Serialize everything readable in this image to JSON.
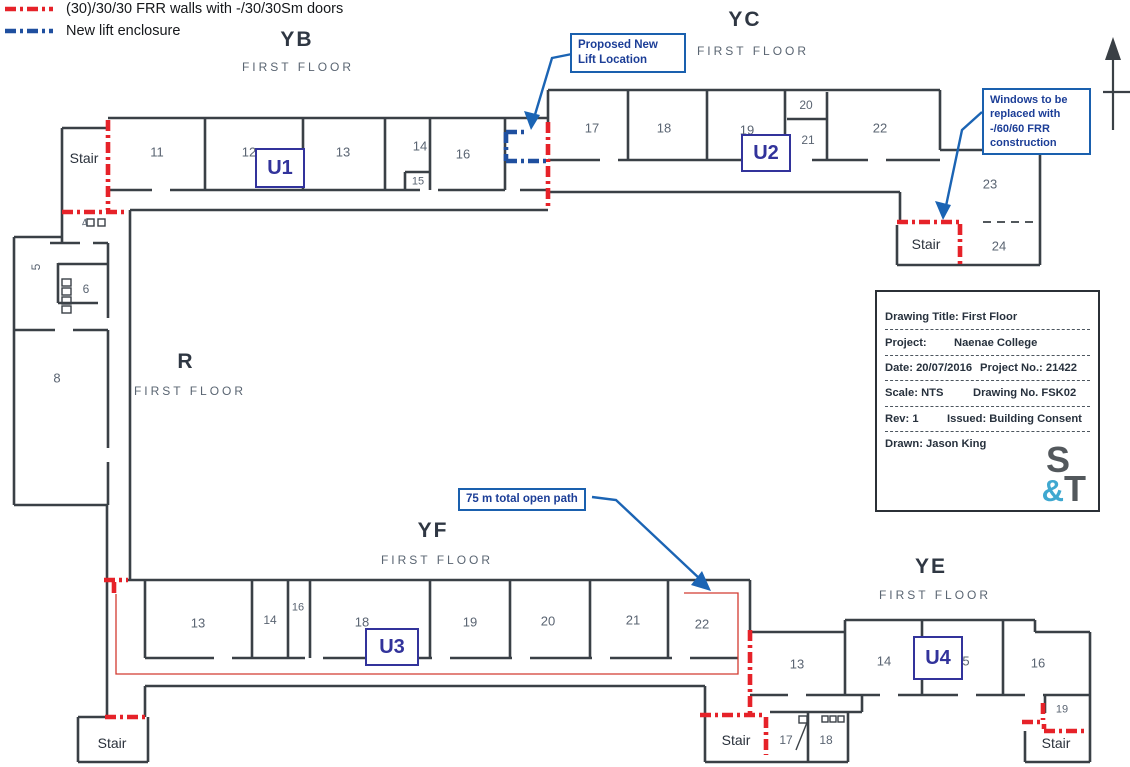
{
  "legend": {
    "items": [
      {
        "name": "frr-walls",
        "label": "(30)/30/30 FRR walls with -/30/30Sm doors",
        "color": "#e62229"
      },
      {
        "name": "new-lift-enclosure",
        "label": "New lift enclosure",
        "color": "#1f4f9f"
      }
    ]
  },
  "blocks": [
    {
      "code": "YB",
      "floor": "FIRST FLOOR"
    },
    {
      "code": "YC",
      "floor": "FIRST FLOOR"
    },
    {
      "code": "R",
      "floor": "FIRST FLOOR"
    },
    {
      "code": "YF",
      "floor": "FIRST FLOOR"
    },
    {
      "code": "YE",
      "floor": "FIRST FLOOR"
    }
  ],
  "callouts": {
    "lift": "Proposed New Lift Location",
    "windows": "Windows to be replaced with -/60/60 FRR construction",
    "open_path": "75 m total open path"
  },
  "title_block": {
    "drawing_title": "Drawing Title: First Floor",
    "project_label": "Project:",
    "project_value": "Naenae College",
    "date": "Date: 20/07/2016",
    "project_no": "Project No.: 21422",
    "scale": "Scale: NTS",
    "drawing_no": "Drawing No. FSK02",
    "rev": "Rev: 1",
    "issued": "Issued: Building Consent",
    "drawn": "Drawn: Jason King",
    "logo": {
      "s": "S",
      "amp": "&",
      "t": "T"
    }
  },
  "plan": {
    "rooms": [
      {
        "t": "11",
        "x": 157,
        "y": 152
      },
      {
        "t": "12",
        "x": 249,
        "y": 152
      },
      {
        "t": "13",
        "x": 343,
        "y": 152
      },
      {
        "t": "14",
        "x": 420,
        "y": 146
      },
      {
        "t": "15",
        "x": 418,
        "y": 182,
        "fs": 11
      },
      {
        "t": "16",
        "x": 463,
        "y": 154
      },
      {
        "t": "17",
        "x": 592,
        "y": 128
      },
      {
        "t": "18",
        "x": 664,
        "y": 128
      },
      {
        "t": "19",
        "x": 747,
        "y": 130
      },
      {
        "t": "20",
        "x": 806,
        "y": 105,
        "fs": 12
      },
      {
        "t": "21",
        "x": 808,
        "y": 140,
        "fs": 12
      },
      {
        "t": "22",
        "x": 880,
        "y": 128
      },
      {
        "t": "23",
        "x": 990,
        "y": 184
      },
      {
        "t": "24",
        "x": 999,
        "y": 246
      },
      {
        "t": "4",
        "x": 85,
        "y": 224,
        "fs": 11,
        "rot": -10
      },
      {
        "t": "5",
        "x": 36,
        "y": 267,
        "fs": 12,
        "rot": -90
      },
      {
        "t": "6",
        "x": 86,
        "y": 289,
        "fs": 12
      },
      {
        "t": "8",
        "x": 57,
        "y": 378
      },
      {
        "t": "13",
        "x": 198,
        "y": 623
      },
      {
        "t": "14",
        "x": 270,
        "y": 620,
        "fs": 12
      },
      {
        "t": "16",
        "x": 298,
        "y": 608,
        "fs": 11
      },
      {
        "t": "18",
        "x": 362,
        "y": 622
      },
      {
        "t": "19",
        "x": 470,
        "y": 622
      },
      {
        "t": "20",
        "x": 548,
        "y": 621
      },
      {
        "t": "21",
        "x": 633,
        "y": 620
      },
      {
        "t": "22",
        "x": 702,
        "y": 624
      },
      {
        "t": "13",
        "x": 797,
        "y": 664
      },
      {
        "t": "14",
        "x": 884,
        "y": 661
      },
      {
        "t": "5",
        "x": 966,
        "y": 661
      },
      {
        "t": "16",
        "x": 1038,
        "y": 663
      },
      {
        "t": "17",
        "x": 786,
        "y": 740,
        "fs": 12
      },
      {
        "t": "18",
        "x": 826,
        "y": 740,
        "fs": 12
      },
      {
        "t": "19",
        "x": 1062,
        "y": 710,
        "fs": 11
      }
    ],
    "stairs": [
      {
        "t": "Stair",
        "x": 84,
        "y": 158
      },
      {
        "t": "Stair",
        "x": 926,
        "y": 244
      },
      {
        "t": "Stair",
        "x": 112,
        "y": 743
      },
      {
        "t": "Stair",
        "x": 736,
        "y": 740
      },
      {
        "t": "Stair",
        "x": 1056,
        "y": 743
      }
    ],
    "units": [
      {
        "t": "U1",
        "x": 280,
        "y": 168,
        "w": 46,
        "h": 36
      },
      {
        "t": "U2",
        "x": 766,
        "y": 153,
        "w": 46,
        "h": 34
      },
      {
        "t": "U3",
        "x": 392,
        "y": 647,
        "w": 50,
        "h": 34
      },
      {
        "t": "U4",
        "x": 938,
        "y": 658,
        "w": 46,
        "h": 40
      }
    ]
  }
}
